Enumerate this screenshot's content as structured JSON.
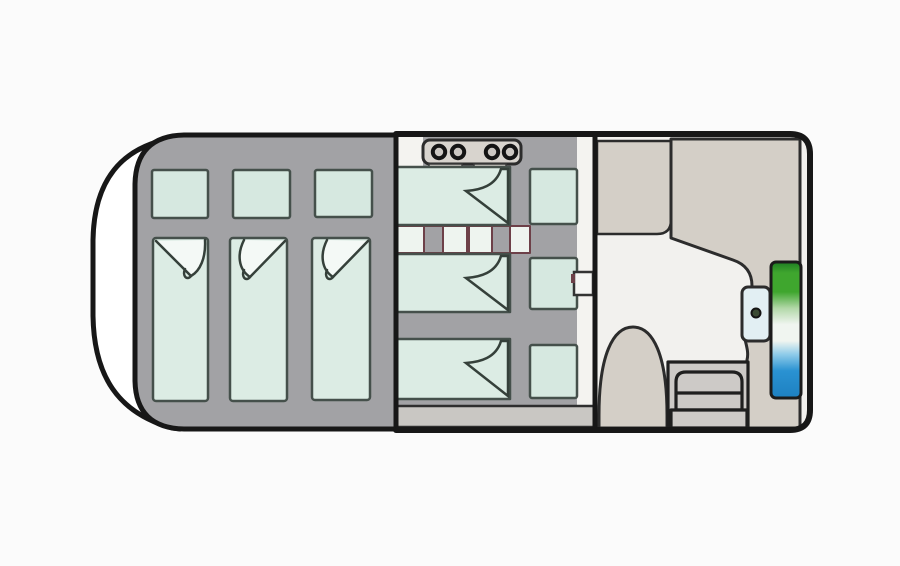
{
  "meta": {
    "subject": "houseboat floor plan illustration, top view",
    "style": "hand-drawn cartoon outline"
  },
  "colors": {
    "background": "#fbfbfb",
    "ink": "#171717",
    "hull": "#ffffff",
    "cabin": "#a2a2a5",
    "floor": "#f4f3f0",
    "salon_floor": "#f2f1ee",
    "beige": "#d4cfc7",
    "mattress": "#dcece4",
    "pillow": "#d6e8e0",
    "fold_white": "#f4f9f6",
    "stove": "#d8d4ce",
    "burner": "#cbc7c2",
    "ladder_white": "#eef4ef",
    "ladder_bar": "#a2a2a5",
    "maroon": "#6d4048",
    "walkway": "#c9c7c3",
    "steps": "#cdcac7",
    "console": "#e2eff3",
    "knob": "#3a4a33",
    "sidebox": "#f5f5f3",
    "view": {
      "green_dark": "#1e7d22",
      "green": "#3fa62e",
      "green_light": "#b2d8a8",
      "white": "#f0f5f0",
      "blue_light": "#8ecbe9",
      "blue": "#2a92d2",
      "blue_dark": "#1d80c1"
    }
  },
  "sections": {
    "bow": {
      "name": "bow hull"
    },
    "left_cabin": {
      "name": "aft sleeping cabin",
      "beds": 3,
      "pillows": 3
    },
    "middle_cabin": {
      "name": "middle sleeping cabin",
      "beds": 3,
      "pillows": 3,
      "stove_burners": 4,
      "ladder_rungs": 2
    },
    "salon": {
      "name": "salon and helm",
      "bench_seats": 2,
      "step_treads": 3,
      "helm_console": 1,
      "window_view": {
        "top": "green shoreline",
        "bottom": "blue water"
      }
    }
  }
}
